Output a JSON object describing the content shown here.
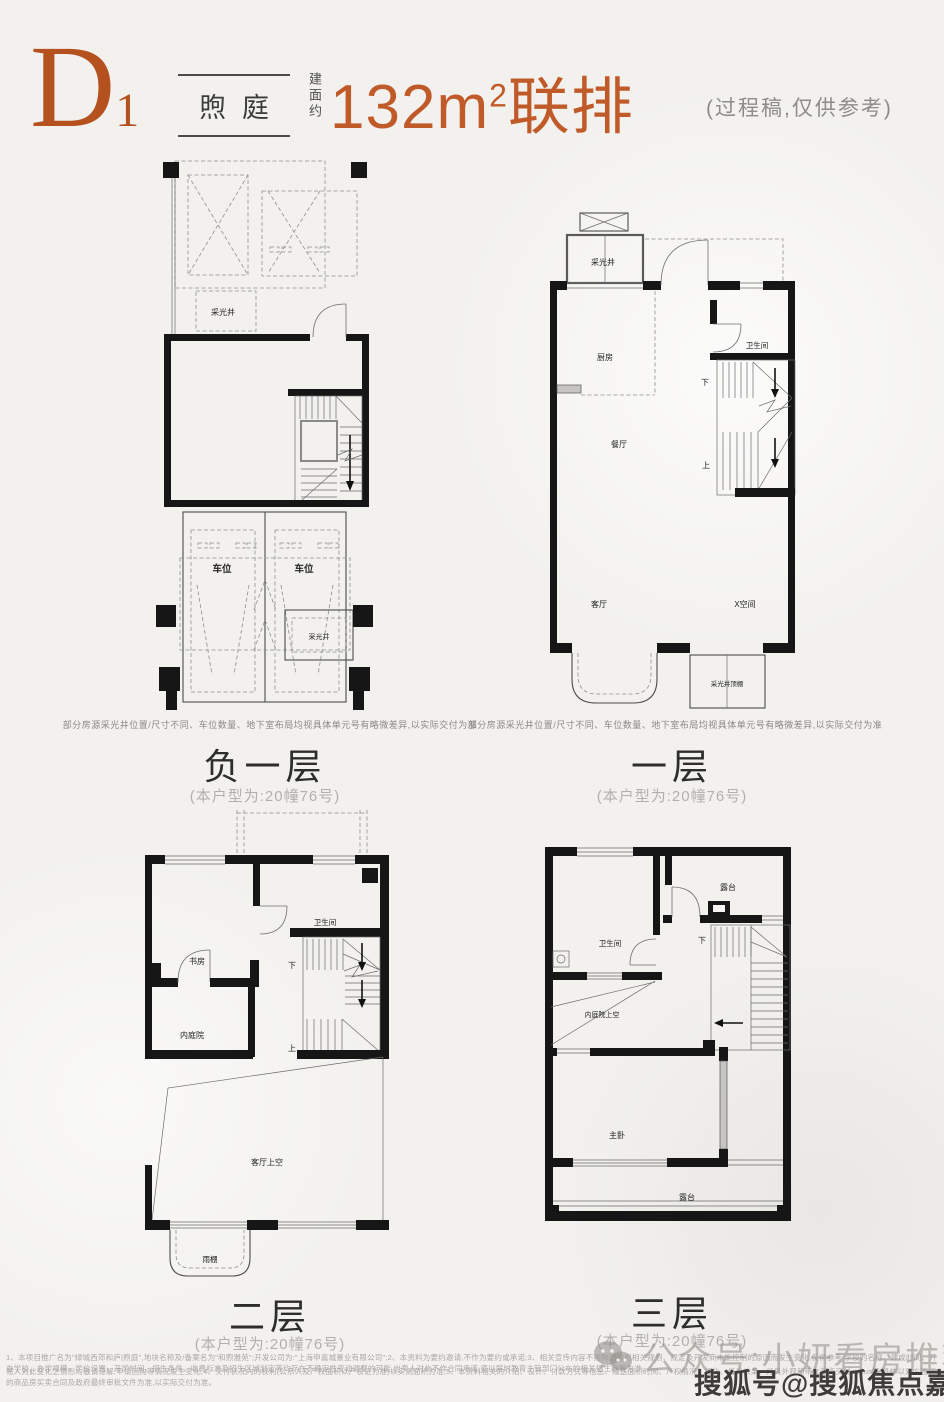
{
  "header": {
    "plan_code": "D",
    "plan_code_sub": "1",
    "project_name": "煦庭",
    "area_prefix": "建面约",
    "area_number": "132m",
    "area_sup": "2",
    "area_suffix": "联排",
    "note": "(过程稿,仅供参考)",
    "accent_color": "#c05a28"
  },
  "floors": [
    {
      "name": "负一层",
      "unit": "(本户型为:20幢76号)",
      "disclaimer": "部分房源采光井位置/尺寸不同、车位数量、地下室布局均视具体单元号有略微差异,以实际交付为准",
      "labels": {
        "light_well_top": "采光井",
        "parking_left": "车位",
        "parking_right": "车位",
        "light_well_bottom": "采光井"
      }
    },
    {
      "name": "一层",
      "unit": "(本户型为:20幢76号)",
      "disclaimer": "部分房源采光井位置/尺寸不同、车位数量、地下室布局均视具体单元号有略微差异,以实际交付为准",
      "labels": {
        "light_well": "采光井",
        "kitchen": "厨房",
        "bath": "卫生间",
        "down": "下",
        "up": "上",
        "dining": "餐厅",
        "living": "客厅",
        "x_space": "X空间",
        "light_well_canopy": "采光井顶棚"
      }
    },
    {
      "name": "二层",
      "unit": "(本户型为:20幢76号)",
      "labels": {
        "study": "书房",
        "bath": "卫生间",
        "down": "下",
        "up": "上",
        "courtyard": "内庭院",
        "living_void": "客厅上空",
        "rain_canopy": "雨棚"
      }
    },
    {
      "name": "三层",
      "unit": "(本户型为:20幢76号)",
      "labels": {
        "terrace_top": "露台",
        "bath": "卫生间",
        "down": "下",
        "courtyard_void": "内庭院上空",
        "master": "主卧",
        "terrace_bottom": "露台"
      }
    }
  ],
  "footer": {
    "disclaimer_line1": "1、本项目推广名为\"绿城西郊和庐|煦庭\",地块名称及/备案名为\"和煦雅苑\";开发公司为:\"上海申嘉城置业有限公司\";2、本资料为要约邀请,不作为要约或承诺;3、相关宣传内容不排除因政府相关规划、规定及开发商未能控制的原因而发生变化,仅供参考,学校的名称、建成时间、开办学校、办学规模、学位设置、开学时间、招生条件、收费标准及招生区域划定等均存在不确定性变动调整的可能,出卖人对此不作合同承诺,须以届时教育主管部门公布的相关招生政策为准,",
    "disclaimer_line2": "易人对此变化之情形均敬请谅解;申请回购等情况发生变化;4、交付状况内的权利(公示人及产权面积以产权证为准)以实测面积为准;5、本资料相关的介绍、设计、付款方式等信息、赠送面积时间、产权情况、绿化、灯光效果、灯具外观和带女装饰交付status等,具体以双方签订的商品房买卖合同及政府最终审批文件为准,以实际交付为准。"
  },
  "watermarks": {
    "wechat": "公众号:小妍看房推荐",
    "sohu": "搜狐号@搜狐焦点嘉峪关站"
  }
}
